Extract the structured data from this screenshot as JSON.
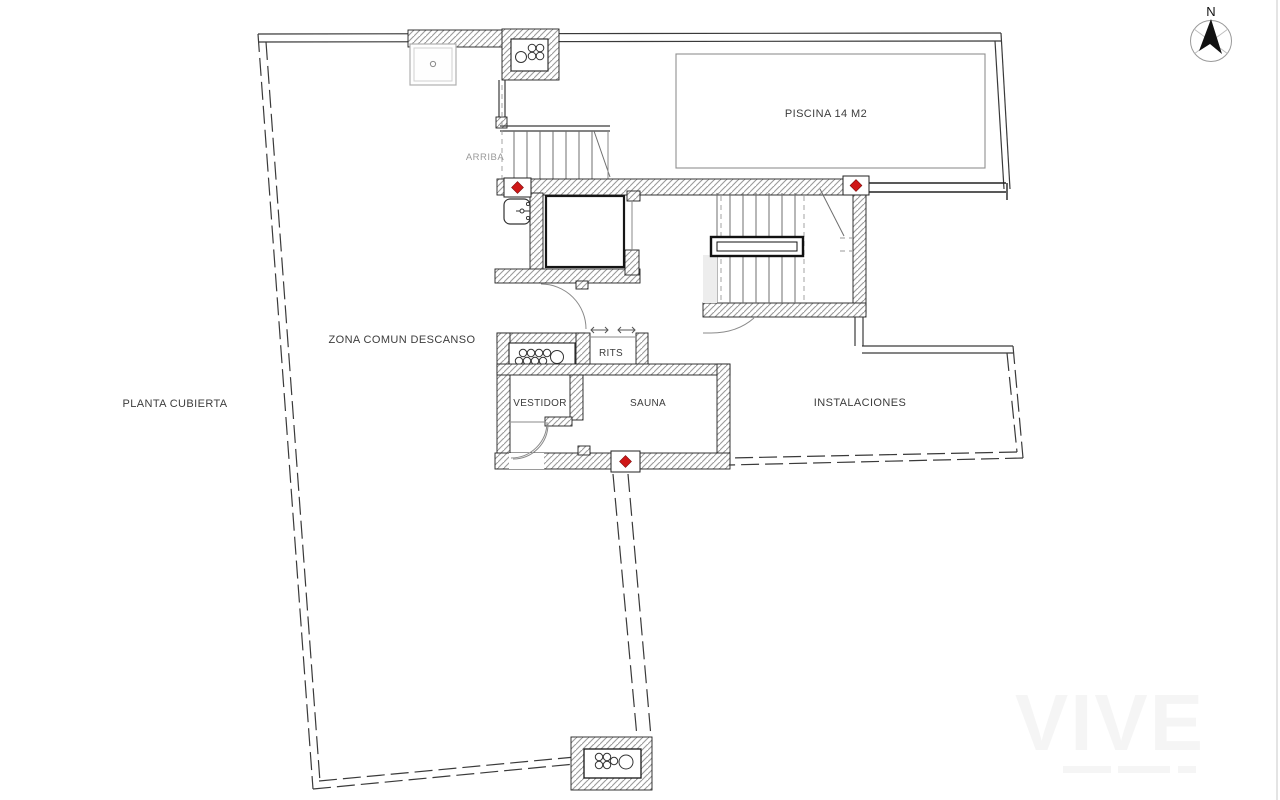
{
  "plan": {
    "title": "PLANTA CUBIERTA",
    "rooms": [
      {
        "id": "piscina",
        "label": "PISCINA 14 M2"
      },
      {
        "id": "zona_comun",
        "label": "ZONA COMUN DESCANSO"
      },
      {
        "id": "rits",
        "label": "RITS"
      },
      {
        "id": "vestidor",
        "label": "VESTIDOR"
      },
      {
        "id": "sauna",
        "label": "SAUNA"
      },
      {
        "id": "instalaciones",
        "label": "INSTALACIONES"
      }
    ],
    "annotations": {
      "stairs_direction": "ARRIBA"
    },
    "compass": {
      "label": "N"
    },
    "watermark": {
      "logo": "VIVE"
    },
    "colors": {
      "marker_red": "#cf1717",
      "wall_hatch": "#9a9a9a",
      "line": "#3a3a3a",
      "muted_text": "#9a9a9a",
      "label_text": "#3c3c3c"
    }
  }
}
